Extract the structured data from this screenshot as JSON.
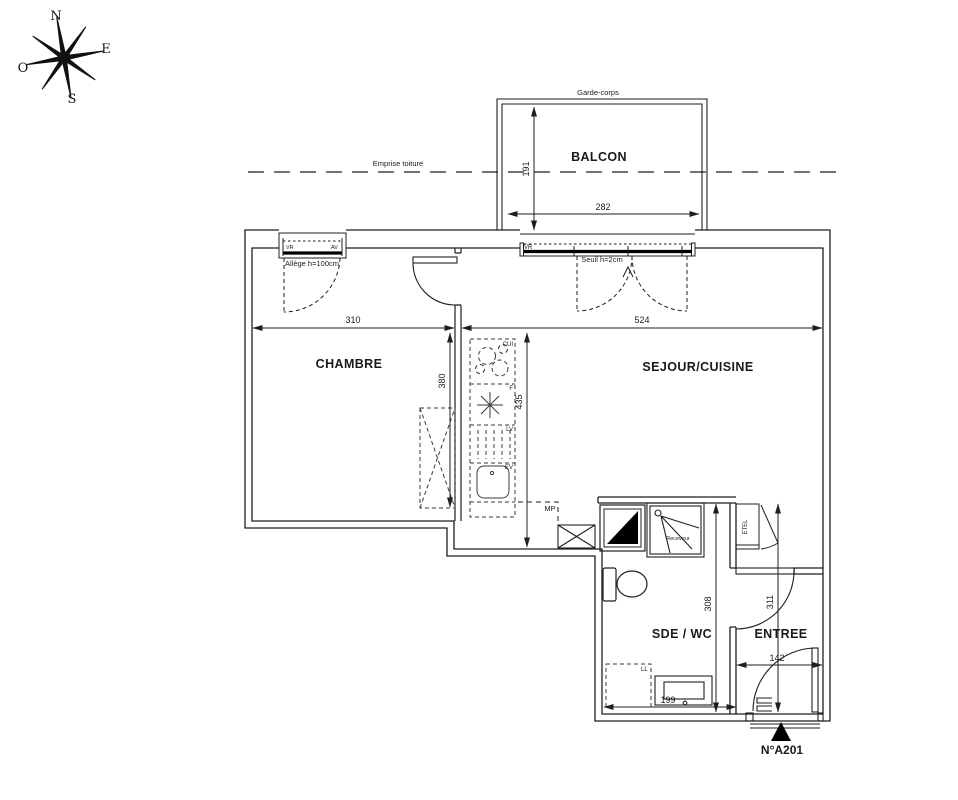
{
  "compass": {
    "north": "N",
    "east": "E",
    "south": "S",
    "west": "O"
  },
  "rooms": {
    "balcony": "BALCON",
    "bedroom": "CHAMBRE",
    "living": "SEJOUR/CUISINE",
    "bathroom": "SDE / WC",
    "entry": "ENTREE"
  },
  "dimensions": {
    "balcony_width": "282",
    "balcony_depth": "191",
    "bedroom_width": "310",
    "living_width": "524",
    "bedroom_depth": "380",
    "living_depth": "435",
    "bathroom_depth": "308",
    "entry_depth": "311",
    "entry_door_width": "142",
    "vanity_width": "199"
  },
  "annotations": {
    "roof_overhang": "Emprise toiture",
    "guardrail": "Garde-corps",
    "window_sill": "Allège h=100cm",
    "door_sill": "Seuil h=2cm",
    "shutter_left": "VR",
    "window_right": "AV",
    "shutter_bay": "VR",
    "mp": "MP",
    "shower_tray": "Receveur",
    "etel": "ETEL",
    "washer": "LL"
  },
  "kitchen": {
    "cooktop": "CUI",
    "fridge": "F",
    "dishwasher": "LV",
    "sink": "EV"
  },
  "unit_label": "N°A201",
  "colors": {
    "line": "#1f1f1f",
    "background": "#ffffff"
  }
}
